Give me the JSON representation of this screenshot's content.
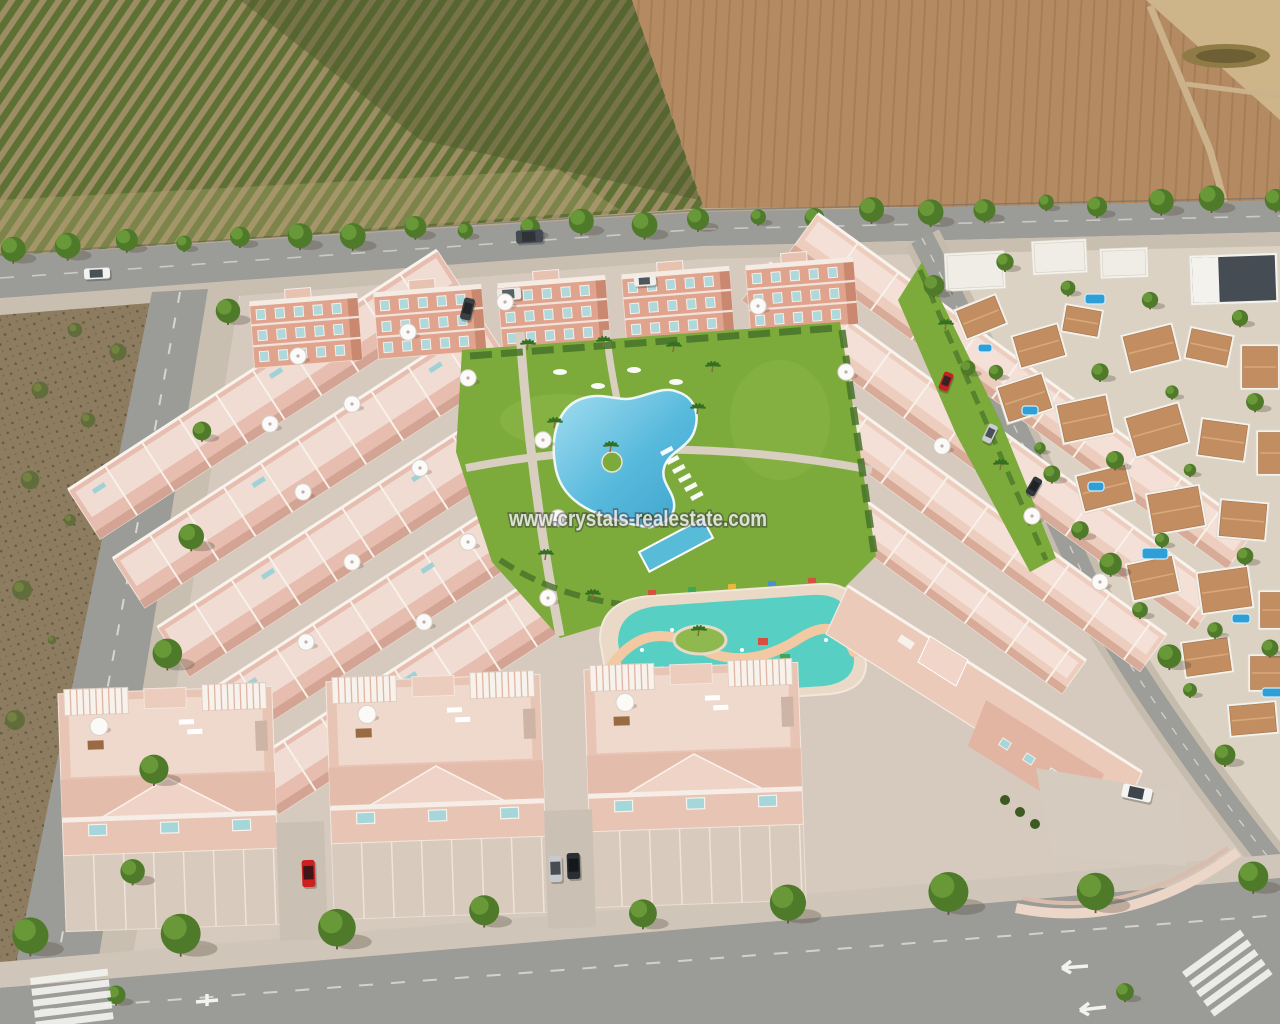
{
  "meta": {
    "title": "Aerial 3D render of a new-build residential development with communal pools",
    "image_type": "architectural-render-photo"
  },
  "watermark": {
    "text": "www.crystals-realestate.com",
    "color": "#ffffff",
    "outline": "#3c3c3c"
  },
  "palette": {
    "building_pink": "#e7c4b4",
    "building_salmon": "#e0a48e",
    "terrace_floor": "#efd9cd",
    "white_trim": "#f6f1ea",
    "window_teal": "#a5d6da",
    "lawn_green": "#7cab3b",
    "pool_blue": "#4fb3d8",
    "kids_pool_turquoise": "#57cfc2",
    "kids_path_peach": "#f2c9a2",
    "orchard_green": "#5f7034",
    "orchard_soil": "#9c8d64",
    "field_brown": "#b48a62",
    "field_pale": "#cdb489",
    "road_gray": "#9b9b98",
    "sidewalk": "#c9bfb1",
    "scrub_dirt": "#8d7c60",
    "villa_white": "#f4f2ec",
    "villa_roof_terracotta": "#c28d60",
    "tree_green": "#4e7a29"
  },
  "scene": {
    "apartment_blocks": [
      {
        "x": 252,
        "y": 300
      },
      {
        "x": 376,
        "y": 291
      },
      {
        "x": 500,
        "y": 282
      },
      {
        "x": 624,
        "y": 273
      },
      {
        "x": 748,
        "y": 264
      }
    ],
    "left_grid": {
      "rows": 5,
      "row_len": 440,
      "row_h": 58,
      "row_gap": 82,
      "first_y": -178
    },
    "right_rows": [
      {
        "y": -120,
        "len": 540,
        "h": 46
      },
      {
        "y": -52,
        "len": 560,
        "h": 46
      },
      {
        "y": 16,
        "len": 520,
        "h": 44
      },
      {
        "y": 84,
        "len": 420,
        "h": 40
      }
    ],
    "twin_blocks": [
      {
        "x": 62,
        "y": 690
      },
      {
        "x": 330,
        "y": 678
      },
      {
        "x": 588,
        "y": 666
      }
    ],
    "driveways": [
      {
        "x": 278,
        "y": 822
      },
      {
        "x": 546,
        "y": 810
      }
    ],
    "parasols": [
      [
        298,
        356
      ],
      [
        408,
        332
      ],
      [
        505,
        302
      ],
      [
        270,
        424
      ],
      [
        352,
        404
      ],
      [
        468,
        378
      ],
      [
        303,
        492
      ],
      [
        420,
        468
      ],
      [
        543,
        440
      ],
      [
        352,
        562
      ],
      [
        468,
        542
      ],
      [
        558,
        518
      ],
      [
        306,
        642
      ],
      [
        424,
        622
      ],
      [
        548,
        598
      ],
      [
        758,
        306
      ],
      [
        846,
        372
      ],
      [
        942,
        446
      ],
      [
        1032,
        516
      ],
      [
        1100,
        582
      ]
    ],
    "garden_loungers": [
      [
        660,
        452
      ],
      [
        666,
        461
      ],
      [
        672,
        470
      ],
      [
        678,
        479
      ],
      [
        684,
        488
      ],
      [
        690,
        497
      ]
    ],
    "lawn_loungers": [
      [
        560,
        372
      ],
      [
        598,
        386
      ],
      [
        634,
        370
      ],
      [
        676,
        382
      ]
    ],
    "palms": [
      [
        527,
        350
      ],
      [
        603,
        347
      ],
      [
        673,
        352
      ],
      [
        712,
        372
      ],
      [
        554,
        428
      ],
      [
        610,
        452
      ],
      [
        646,
        524
      ],
      [
        697,
        414
      ],
      [
        545,
        560
      ],
      [
        698,
        636
      ],
      [
        592,
        600
      ],
      [
        945,
        330
      ],
      [
        1000,
        470
      ]
    ],
    "scrub_shrubs": [
      [
        25,
        300
      ],
      [
        75,
        330
      ],
      [
        118,
        352
      ],
      [
        40,
        390
      ],
      [
        88,
        420
      ],
      [
        30,
        480
      ],
      [
        70,
        520
      ],
      [
        22,
        590
      ],
      [
        52,
        640
      ],
      [
        15,
        720
      ]
    ],
    "tree_lines": [
      {
        "layer": "back",
        "x1": 10,
        "y1": 246,
        "x2": 1272,
        "y2": 196,
        "n": 23,
        "r": 10,
        "rv": 3,
        "jy": 4
      },
      {
        "layer": "front",
        "x1": 224,
        "y1": 312,
        "x2": 114,
        "y2": 990,
        "n": 7,
        "r": 12,
        "rv": 3,
        "jy": 6
      },
      {
        "layer": "front",
        "x1": 28,
        "y1": 938,
        "x2": 1250,
        "y2": 878,
        "n": 9,
        "r": 16,
        "rv": 4,
        "jy": 6
      },
      {
        "layer": "front",
        "x1": 935,
        "y1": 282,
        "x2": 1225,
        "y2": 750,
        "n": 6,
        "r": 9,
        "rv": 3,
        "jy": 5
      }
    ],
    "villas": [
      [
        945,
        252,
        60,
        38,
        -3,
        "flat"
      ],
      [
        1032,
        240,
        55,
        34,
        -3,
        "flat"
      ],
      [
        1100,
        248,
        48,
        30,
        -2,
        "flat"
      ],
      [
        1190,
        254,
        88,
        50,
        -2,
        "dark"
      ],
      [
        958,
        300,
        46,
        34,
        -22,
        "terra"
      ],
      [
        1014,
        328,
        50,
        36,
        -16,
        "terra"
      ],
      [
        1062,
        306,
        40,
        30,
        10,
        "terra"
      ],
      [
        1124,
        328,
        54,
        40,
        -14,
        "terra"
      ],
      [
        1186,
        330,
        46,
        34,
        12,
        "terra"
      ],
      [
        1240,
        344,
        40,
        46,
        0,
        "terra"
      ],
      [
        1000,
        378,
        50,
        40,
        -18,
        "terra"
      ],
      [
        1058,
        398,
        54,
        42,
        -12,
        "terra"
      ],
      [
        1128,
        408,
        58,
        44,
        -16,
        "terra"
      ],
      [
        1198,
        420,
        50,
        40,
        8,
        "terra"
      ],
      [
        1256,
        430,
        36,
        46,
        0,
        "terra"
      ],
      [
        1078,
        468,
        54,
        40,
        -14,
        "terra"
      ],
      [
        1148,
        488,
        56,
        44,
        -10,
        "terra"
      ],
      [
        1218,
        500,
        50,
        40,
        5,
        "terra"
      ],
      [
        1128,
        558,
        50,
        40,
        -12,
        "terra"
      ],
      [
        1198,
        568,
        54,
        44,
        -8,
        "terra"
      ],
      [
        1258,
        590,
        40,
        40,
        0,
        "terra"
      ],
      [
        1182,
        638,
        50,
        38,
        -8,
        "terra"
      ],
      [
        1248,
        654,
        44,
        38,
        0,
        "terra"
      ],
      [
        1228,
        702,
        50,
        34,
        -5,
        "terra"
      ]
    ],
    "villa_pools": [
      [
        1085,
        294,
        20,
        10
      ],
      [
        978,
        344,
        14,
        8
      ],
      [
        1022,
        406,
        16,
        9
      ],
      [
        1088,
        482,
        16,
        9
      ],
      [
        1142,
        548,
        26,
        11
      ],
      [
        1232,
        614,
        18,
        9
      ],
      [
        1262,
        688,
        20,
        9
      ]
    ],
    "villa_trees": [
      [
        1005,
        262
      ],
      [
        1068,
        288
      ],
      [
        1150,
        300
      ],
      [
        1240,
        318
      ],
      [
        968,
        368
      ],
      [
        1100,
        372
      ],
      [
        1172,
        392
      ],
      [
        1255,
        402
      ],
      [
        1040,
        448
      ],
      [
        1115,
        460
      ],
      [
        1190,
        470
      ],
      [
        1080,
        530
      ],
      [
        1162,
        540
      ],
      [
        1245,
        556
      ],
      [
        1140,
        610
      ],
      [
        1215,
        630
      ],
      [
        1270,
        648
      ],
      [
        1190,
        690
      ],
      [
        1125,
        992
      ]
    ],
    "vehicles": [
      {
        "name": "white-car-road",
        "x": 84,
        "y": 268,
        "w": 26,
        "h": 11,
        "rot": -3,
        "body": "#f2f2f0",
        "glass": "#4a5258"
      },
      {
        "name": "dark-van-road",
        "x": 516,
        "y": 230,
        "w": 27,
        "h": 13,
        "rot": -3,
        "body": "#454a50",
        "glass": "#2e3338"
      },
      {
        "name": "white-van-parking",
        "x": 497,
        "y": 288,
        "w": 24,
        "h": 12,
        "rot": -4,
        "body": "#eceae6",
        "glass": "#5a6166"
      },
      {
        "name": "dark-car-apartments",
        "x": 462,
        "y": 298,
        "w": 11,
        "h": 22,
        "rot": 14,
        "body": "#3c4043",
        "glass": "#23272a"
      },
      {
        "name": "white-car-apartments",
        "x": 634,
        "y": 276,
        "w": 22,
        "h": 10,
        "rot": -4,
        "body": "#f0efec",
        "glass": "#50575c"
      },
      {
        "name": "red-car-right-street",
        "x": 941,
        "y": 372,
        "w": 10,
        "h": 19,
        "rot": 22,
        "body": "#c32222",
        "glass": "#3a2222"
      },
      {
        "name": "silver-car-right-street",
        "x": 985,
        "y": 424,
        "w": 10,
        "h": 19,
        "rot": 26,
        "body": "#c9cdd1",
        "glass": "#4a5156"
      },
      {
        "name": "dark-car-right-street",
        "x": 1029,
        "y": 477,
        "w": 10,
        "h": 19,
        "rot": 30,
        "body": "#33373c",
        "glass": "#1e2226"
      },
      {
        "name": "red-car-driveway",
        "x": 302,
        "y": 860,
        "w": 13,
        "h": 27,
        "rot": -2,
        "body": "#cc2020",
        "glass": "#401616"
      },
      {
        "name": "silver-car-driveway",
        "x": 549,
        "y": 856,
        "w": 13,
        "h": 26,
        "rot": -2,
        "body": "#c6cacd",
        "glass": "#474d52"
      },
      {
        "name": "black-car-driveway",
        "x": 567,
        "y": 853,
        "w": 13,
        "h": 26,
        "rot": -2,
        "body": "#2b2f33",
        "glass": "#15181b"
      },
      {
        "name": "white-suv-driveway",
        "x": 1122,
        "y": 786,
        "w": 30,
        "h": 14,
        "rot": 12,
        "body": "#f4f4f2",
        "glass": "#3e454b"
      }
    ]
  }
}
